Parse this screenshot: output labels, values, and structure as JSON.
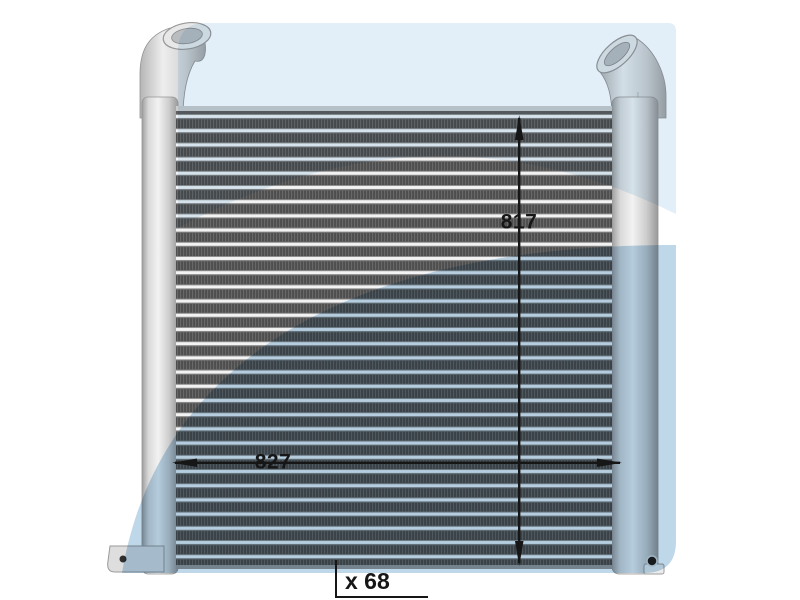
{
  "dimension_labels": {
    "vertical": "817",
    "horizontal": "827",
    "depth": "x 68"
  },
  "colors": {
    "background_pale_blue": "#e2eff8",
    "background_swoosh_blue": "#bed7e9",
    "annotation_black": "#161616",
    "core_fin_dark": "#4e4e4e",
    "core_tube_light": "#f3f3f3",
    "tank_aluminum": "#d6d6d6"
  }
}
